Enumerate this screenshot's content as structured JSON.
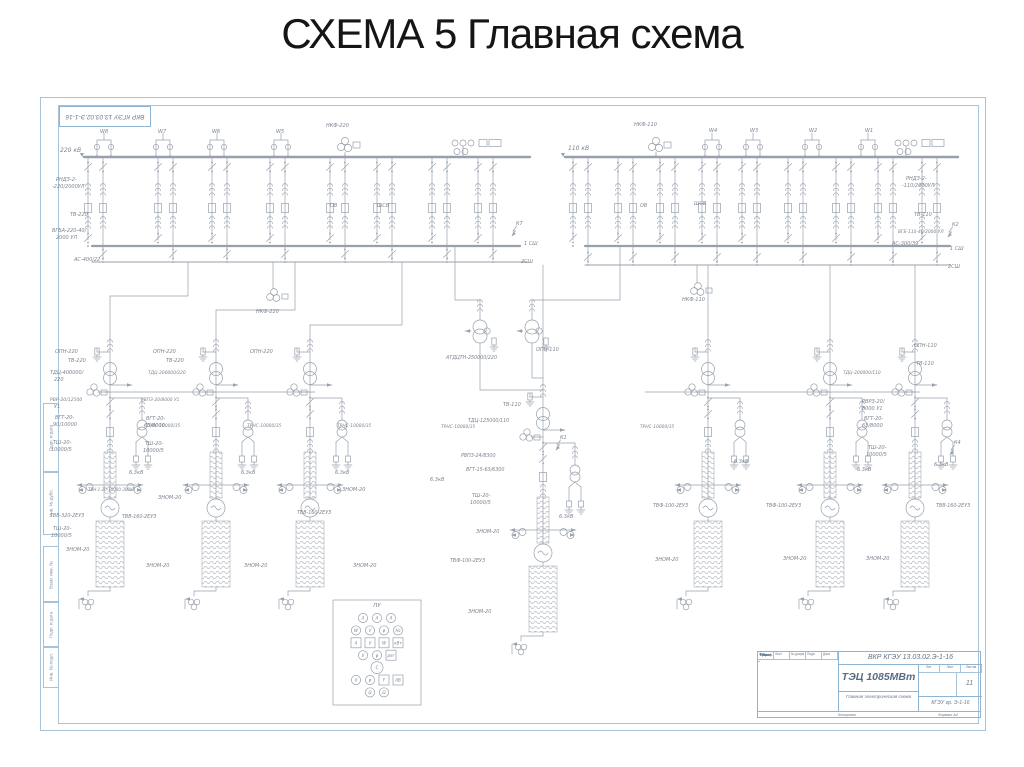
{
  "slide": {
    "title": "СХЕМА 5 Главная схема"
  },
  "frame": {
    "corner_stamp": "ВКР КГЭУ 13.03.02.Э-1-16",
    "side_strips": [
      {
        "label": "Подп. и дата",
        "y": 402,
        "h": 68
      },
      {
        "label": "Инв. № дубл.",
        "y": 470,
        "h": 62
      },
      {
        "label": "Взам. инв. №",
        "y": 545,
        "h": 55
      },
      {
        "label": "Подп. и дата",
        "y": 600,
        "h": 45
      },
      {
        "label": "Инв. № подл.",
        "y": 645,
        "h": 40
      }
    ]
  },
  "title_block": {
    "doc_number": "ВКР КГЭУ 13.03.02.Э-1-16",
    "object": "ТЭЦ 1085МВт",
    "doc_title": "Главная электрическая схема",
    "org": "КГЭУ гр. Э-1-16",
    "sheet_no": "11",
    "left_header": [
      "Изм.",
      "Лист",
      "№ докум.",
      "Подп.",
      "Дата"
    ],
    "left_rows": [
      "Разраб.",
      "Пров.",
      "Реценз.",
      "Н.контр.",
      "Утв."
    ],
    "right_header": [
      "Лит.",
      "Лист",
      "Листов"
    ],
    "bottom_left": "Копировал",
    "bottom_right": "Формат А4"
  },
  "schematic": {
    "colors": {
      "line": "#98a0ab",
      "bus": "#8d949e",
      "text": "#7c8390",
      "frame": "#a6c3da"
    },
    "buses": [
      {
        "x1": 84,
        "y": 157,
        "x2": 530,
        "w": 2.4,
        "tick": true
      },
      {
        "x1": 92,
        "y": 246,
        "x2": 520,
        "w": 2.2
      },
      {
        "x1": 92,
        "y": 262,
        "x2": 528,
        "w": 1.1
      },
      {
        "x1": 565,
        "y": 157,
        "x2": 958,
        "w": 2.4,
        "tick": true
      },
      {
        "x1": 585,
        "y": 246,
        "x2": 950,
        "w": 2.2
      },
      {
        "x1": 585,
        "y": 265,
        "x2": 950,
        "w": 1.1
      }
    ],
    "routes": [
      [
        [
          188,
          262
        ],
        [
          188,
          296
        ],
        [
          110,
          296
        ],
        [
          110,
          342
        ]
      ],
      [
        [
          295,
          262
        ],
        [
          295,
          310
        ],
        [
          216,
          310
        ],
        [
          216,
          342
        ]
      ],
      [
        [
          402,
          262
        ],
        [
          402,
          325
        ],
        [
          310,
          325
        ],
        [
          310,
          342
        ]
      ],
      [
        [
          543,
          265
        ],
        [
          543,
          378
        ]
      ],
      [
        [
          708,
          265
        ],
        [
          708,
          342
        ]
      ],
      [
        [
          830,
          265
        ],
        [
          830,
          342
        ]
      ],
      [
        [
          915,
          265
        ],
        [
          915,
          342
        ]
      ],
      [
        [
          455,
          246
        ],
        [
          455,
          300
        ],
        [
          480,
          300
        ],
        [
          480,
          320
        ]
      ],
      [
        [
          620,
          246
        ],
        [
          620,
          300
        ],
        [
          532,
          300
        ],
        [
          532,
          320
        ]
      ],
      [
        [
          480,
          343
        ],
        [
          480,
          390
        ],
        [
          543,
          390
        ]
      ],
      [
        [
          532,
          343
        ],
        [
          532,
          378
        ],
        [
          543,
          378
        ]
      ],
      [
        [
          273,
          262
        ],
        [
          273,
          289
        ]
      ],
      [
        [
          697,
          265
        ],
        [
          697,
          283
        ]
      ],
      [
        [
          104,
          392
        ],
        [
          315,
          392
        ]
      ],
      [
        [
          645,
          392
        ],
        [
          920,
          392
        ]
      ]
    ],
    "line_bays": {
      "left": [
        104,
        163,
        217,
        281
      ],
      "right": [
        712,
        753,
        812,
        868
      ]
    },
    "vt_top": [
      {
        "x": 345,
        "y": 146
      },
      {
        "x": 656,
        "y": 146
      }
    ],
    "instr_top": [
      {
        "x": 455,
        "y": 143
      },
      {
        "x": 898,
        "y": 143
      }
    ],
    "vt_mid": [
      {
        "x": 273,
        "y": 294
      },
      {
        "x": 697,
        "y": 288
      }
    ],
    "feeders": {
      "left": {
        "xs": [
          88,
          103,
          158,
          173,
          212,
          227,
          270,
          285,
          330,
          345,
          377,
          392,
          432,
          447,
          478,
          493
        ],
        "b3": 262
      },
      "right": {
        "xs": [
          573,
          588,
          618,
          633,
          660,
          675,
          702,
          717,
          742,
          757,
          788,
          803,
          836,
          851,
          878,
          893,
          922,
          937
        ],
        "b3": 265
      }
    },
    "autotransformers": [
      {
        "x": 480,
        "y": 320
      },
      {
        "x": 532,
        "y": 320
      }
    ],
    "unit_bays": [
      {
        "x": 110,
        "ty": 368,
        "sy": 342
      },
      {
        "x": 216,
        "ty": 368,
        "sy": 342
      },
      {
        "x": 310,
        "ty": 368,
        "sy": 342
      },
      {
        "x": 543,
        "ty": 413,
        "sy": 378
      },
      {
        "x": 708,
        "ty": 368,
        "sy": 342
      },
      {
        "x": 830,
        "ty": 368,
        "sy": 342
      },
      {
        "x": 915,
        "ty": 368,
        "sy": 342
      }
    ],
    "faults": [
      {
        "x": 512,
        "y": 236,
        "label": "К7"
      },
      {
        "x": 948,
        "y": 237,
        "label": "К2"
      },
      {
        "x": 556,
        "y": 450,
        "label": "К1"
      },
      {
        "x": 950,
        "y": 455,
        "label": "К4"
      }
    ],
    "pu_panel": {
      "x": 333,
      "y": 600,
      "w": 88,
      "h": 105,
      "title": "ПУ",
      "rows": [
        [
          {
            "t": "c",
            "l": "А"
          },
          {
            "t": "c",
            "l": "А"
          },
          {
            "t": "c",
            "l": "А"
          }
        ],
        [
          {
            "t": "c",
            "l": "W"
          },
          {
            "t": "c",
            "l": "V"
          },
          {
            "t": "c",
            "l": "φ"
          },
          {
            "t": "c",
            "l": "Hz"
          }
        ],
        [
          {
            "t": "r",
            "l": "А"
          },
          {
            "t": "r",
            "l": "V"
          },
          {
            "t": "r",
            "l": "W"
          },
          {
            "t": "r",
            "l": "кВт"
          }
        ],
        [
          {
            "t": "c",
            "l": "V"
          },
          {
            "t": "c",
            "l": "φ"
          },
          {
            "t": "r",
            "l": "рег"
          }
        ],
        [
          {
            "t": "C",
            "l": "С"
          }
        ],
        [
          {
            "t": "c",
            "l": "V"
          },
          {
            "t": "c",
            "l": "φ"
          },
          {
            "t": "r",
            "l": "F"
          },
          {
            "t": "r",
            "l": "АВ"
          }
        ],
        [
          {
            "t": "c",
            "l": "Ω"
          },
          {
            "t": "c",
            "l": "Ω"
          }
        ]
      ]
    },
    "labels": [
      [
        60,
        152,
        "220 кВ",
        6
      ],
      [
        100,
        133,
        "W8"
      ],
      [
        158,
        133,
        "W7"
      ],
      [
        212,
        133,
        "W6"
      ],
      [
        276,
        133,
        "W5"
      ],
      [
        326,
        127,
        "НКФ-220"
      ],
      [
        568,
        150,
        "110 кВ",
        6
      ],
      [
        634,
        126,
        "НКФ-110"
      ],
      [
        709,
        132,
        "W4"
      ],
      [
        750,
        132,
        "W3"
      ],
      [
        809,
        132,
        "W2"
      ],
      [
        865,
        132,
        "W1"
      ],
      [
        56,
        181,
        "РНДЗ-2-"
      ],
      [
        52,
        188,
        "-220/2000УЛ"
      ],
      [
        70,
        216,
        "ТВ-220"
      ],
      [
        52,
        232,
        "ВГБА-220-40/"
      ],
      [
        56,
        239,
        "2000 УЛ"
      ],
      [
        74,
        261,
        "АС-400/22"
      ],
      [
        524,
        245,
        "1 СШ"
      ],
      [
        521,
        263,
        "2СШ"
      ],
      [
        906,
        180,
        "РНДЗ-2-"
      ],
      [
        902,
        187,
        "-110/2000УЛ"
      ],
      [
        914,
        216,
        "ТВ-110"
      ],
      [
        898,
        233,
        "ВГБ-110-40/2000 УЛ",
        4.4
      ],
      [
        892,
        245,
        "АС-300/39"
      ],
      [
        950,
        250,
        "1 СШ"
      ],
      [
        948,
        268,
        "2СШ"
      ],
      [
        330,
        207,
        "ОВ"
      ],
      [
        377,
        207,
        "ШСВ"
      ],
      [
        640,
        207,
        "ОВ"
      ],
      [
        694,
        205,
        "ШСВ"
      ],
      [
        256,
        313,
        "НКФ-220"
      ],
      [
        682,
        301,
        "НКФ-110"
      ],
      [
        446,
        359,
        "АТДЦТН-250000/220",
        4.8
      ],
      [
        536,
        351,
        "ОПН-110"
      ],
      [
        503,
        406,
        "ТВ-110"
      ],
      [
        468,
        422,
        "ТДЦ-125000/110",
        4.8
      ],
      [
        461,
        457,
        "РВПЗ-24/8300",
        4.8
      ],
      [
        466,
        471,
        "ВГТ-15-63/6300",
        4.8
      ],
      [
        472,
        497,
        "ТШ-20-"
      ],
      [
        470,
        504,
        "10000/5"
      ],
      [
        476,
        533,
        "ЗНОМ-20"
      ],
      [
        450,
        562,
        "ТВФ-100-2ЕУЗ",
        4.8
      ],
      [
        468,
        613,
        "ЗНОМ-20"
      ],
      [
        559,
        518,
        "6.3кВ"
      ],
      [
        430,
        481,
        "6.3кВ"
      ],
      [
        441,
        428,
        "ТРНС-10000/35",
        4.4
      ],
      [
        55,
        353,
        "ОПН-220"
      ],
      [
        68,
        362,
        "ТВ-220"
      ],
      [
        50,
        374,
        "ТДЦ-400000/"
      ],
      [
        54,
        381,
        "220"
      ],
      [
        50,
        401,
        "РВР-20/12500",
        4.6
      ],
      [
        54,
        408,
        "У1"
      ],
      [
        55,
        419,
        "ВГТ-20-"
      ],
      [
        53,
        426,
        "90/10000"
      ],
      [
        53,
        444,
        "ТШ-20-"
      ],
      [
        51,
        451,
        "10000/5"
      ],
      [
        88,
        491,
        "ТВН-1-20-10000-300У3",
        4.0
      ],
      [
        50,
        517,
        "ТВВ-320-2ЕУЗ",
        4.8
      ],
      [
        53,
        530,
        "ТШ-20-"
      ],
      [
        51,
        537,
        "10000/5"
      ],
      [
        66,
        551,
        "ЗНОМ-20"
      ],
      [
        146,
        567,
        "ЗНОМ-20"
      ],
      [
        146,
        427,
        "ТРНС-10000/35",
        4.4
      ],
      [
        129,
        474,
        "6.3кВ"
      ],
      [
        153,
        353,
        "ОПН-220"
      ],
      [
        166,
        362,
        "ТВ-220"
      ],
      [
        148,
        374,
        "ТДЦ-200000/220",
        4.4
      ],
      [
        141,
        401,
        "РВПЗ-20/8000 У1",
        4.4
      ],
      [
        146,
        420,
        "ВГТ-20-"
      ],
      [
        144,
        427,
        "63/8000"
      ],
      [
        145,
        445,
        "ТШ-20-"
      ],
      [
        143,
        452,
        "10000/5"
      ],
      [
        158,
        499,
        "ЗНОМ-20"
      ],
      [
        122,
        518,
        "ТВВ-160-2ЕУЗ",
        4.8
      ],
      [
        247,
        427,
        "ТРНС-10000/35",
        4.4
      ],
      [
        241,
        474,
        "6.3кВ"
      ],
      [
        244,
        567,
        "ЗНОМ-20"
      ],
      [
        250,
        353,
        "ОПН-220"
      ],
      [
        342,
        491,
        "ЗНОМ-20"
      ],
      [
        297,
        514,
        "ТВВ-160-2ЕУЗ",
        4.8
      ],
      [
        337,
        427,
        "ТРНС-10000/35",
        4.4
      ],
      [
        335,
        474,
        "6.3кВ"
      ],
      [
        353,
        567,
        "ЗНОМ-20"
      ],
      [
        640,
        428,
        "ТРНС-10000/35",
        4.4
      ],
      [
        653,
        507,
        "ТВФ-100-2ЕУЗ",
        4.8
      ],
      [
        655,
        561,
        "ЗНОМ-20"
      ],
      [
        734,
        463,
        "6.3кВ"
      ],
      [
        766,
        507,
        "ТВФ-100-2ЕУЗ",
        4.8
      ],
      [
        783,
        560,
        "ЗНОМ-20"
      ],
      [
        857,
        471,
        "6.3кВ"
      ],
      [
        914,
        347,
        "ОПН-110"
      ],
      [
        916,
        365,
        "ТВ-110"
      ],
      [
        843,
        374,
        "ТДЦ-200000/110",
        4.4
      ],
      [
        862,
        403,
        "РВРЗ-20/"
      ],
      [
        862,
        410,
        "8000 У1"
      ],
      [
        864,
        420,
        "ВГТ-20-"
      ],
      [
        862,
        427,
        "63/8000"
      ],
      [
        868,
        449,
        "ТШ-20-"
      ],
      [
        866,
        456,
        "10000/5"
      ],
      [
        934,
        466,
        "6.3кВ"
      ],
      [
        936,
        507,
        "ТВВ-160-2ЕУЗ",
        4.8
      ],
      [
        866,
        560,
        "ЗНОМ-20"
      ]
    ]
  }
}
